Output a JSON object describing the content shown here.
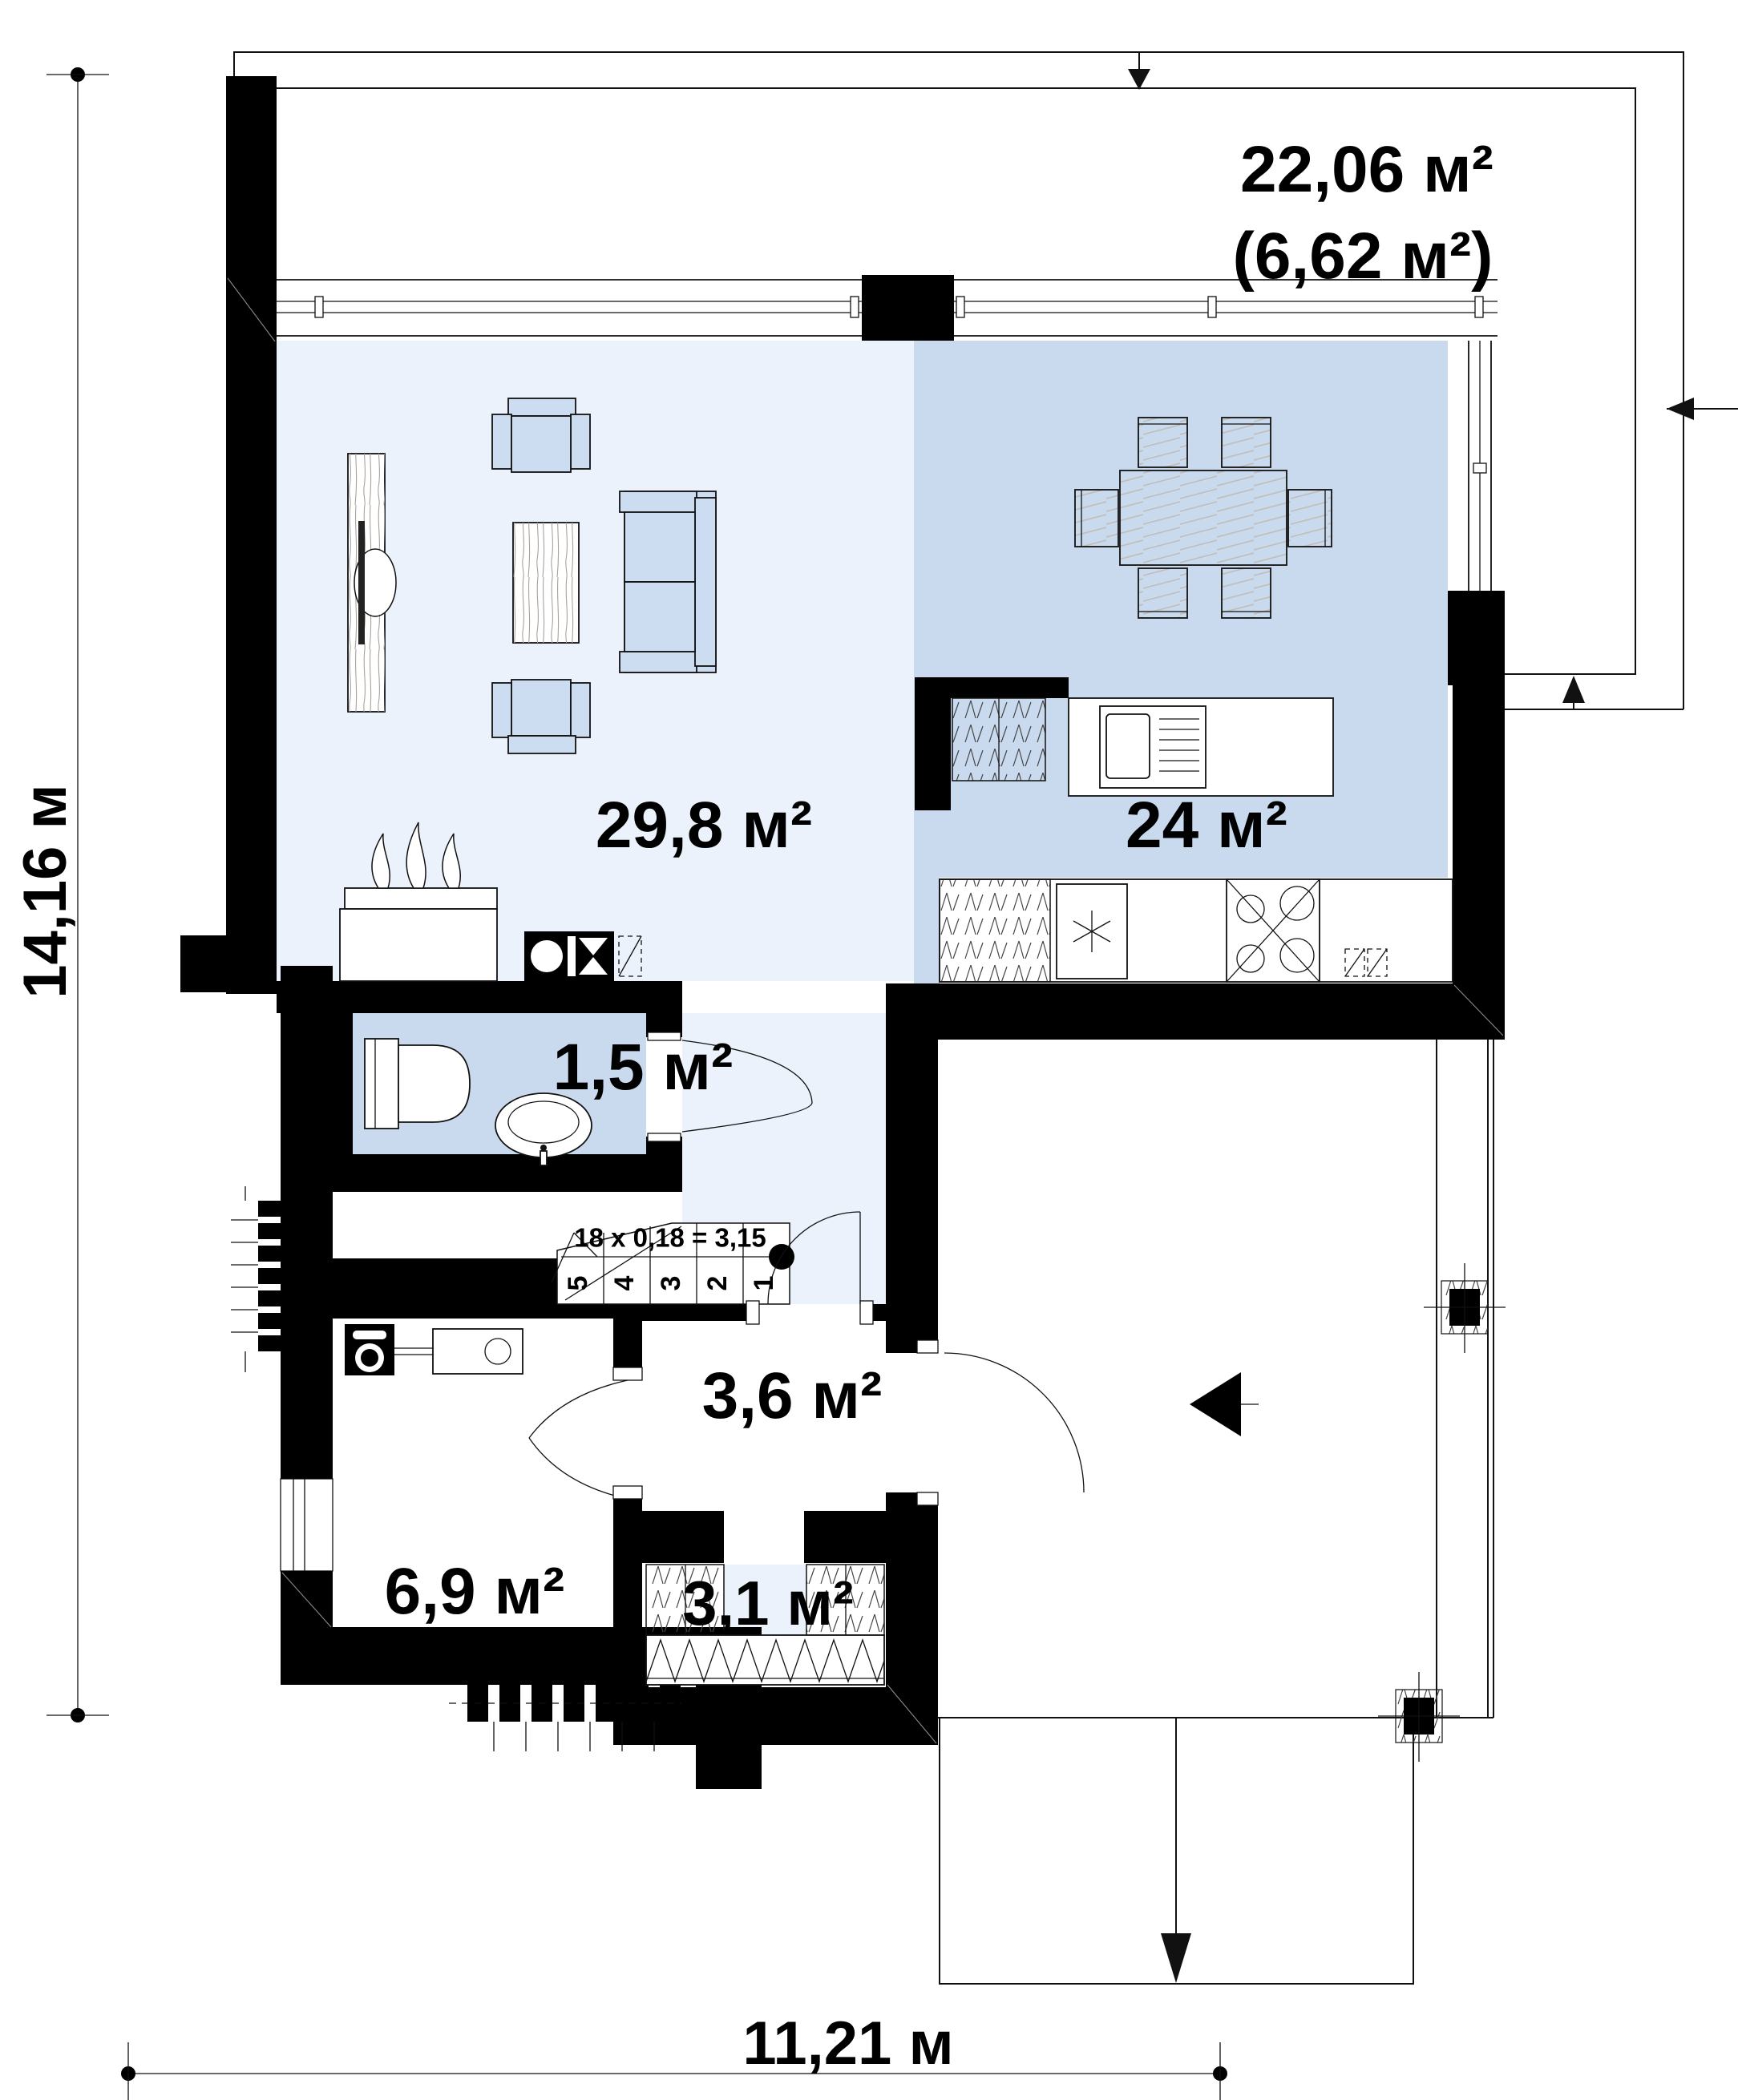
{
  "plan": {
    "dimensions": {
      "height": "14,16 м",
      "width": "11,21 м"
    },
    "terrace": {
      "total_area": "22,06 м²",
      "covered_area": "(6,62 м²)"
    },
    "rooms": {
      "living": {
        "area": "29,8 м²"
      },
      "kitchen_dining": {
        "area": "24 м²"
      },
      "bathroom": {
        "area": "1,5 м²"
      },
      "hall": {
        "area": "3,6 м²"
      },
      "utility": {
        "area": "6,9 м²"
      },
      "wardrobe": {
        "area": "3,1 м²"
      }
    },
    "stairs": {
      "formula": "18 x 0,18 = 3,15",
      "steps": [
        "1",
        "2",
        "3",
        "4",
        "5"
      ]
    },
    "colors": {
      "wall": "#000000",
      "line": "#111111",
      "room_light": "#ebf2fb",
      "room_medium": "#c9daef",
      "furniture": "#ccdcf1",
      "hatch": "#c3bcb6",
      "wood": "#a9a29b"
    }
  }
}
